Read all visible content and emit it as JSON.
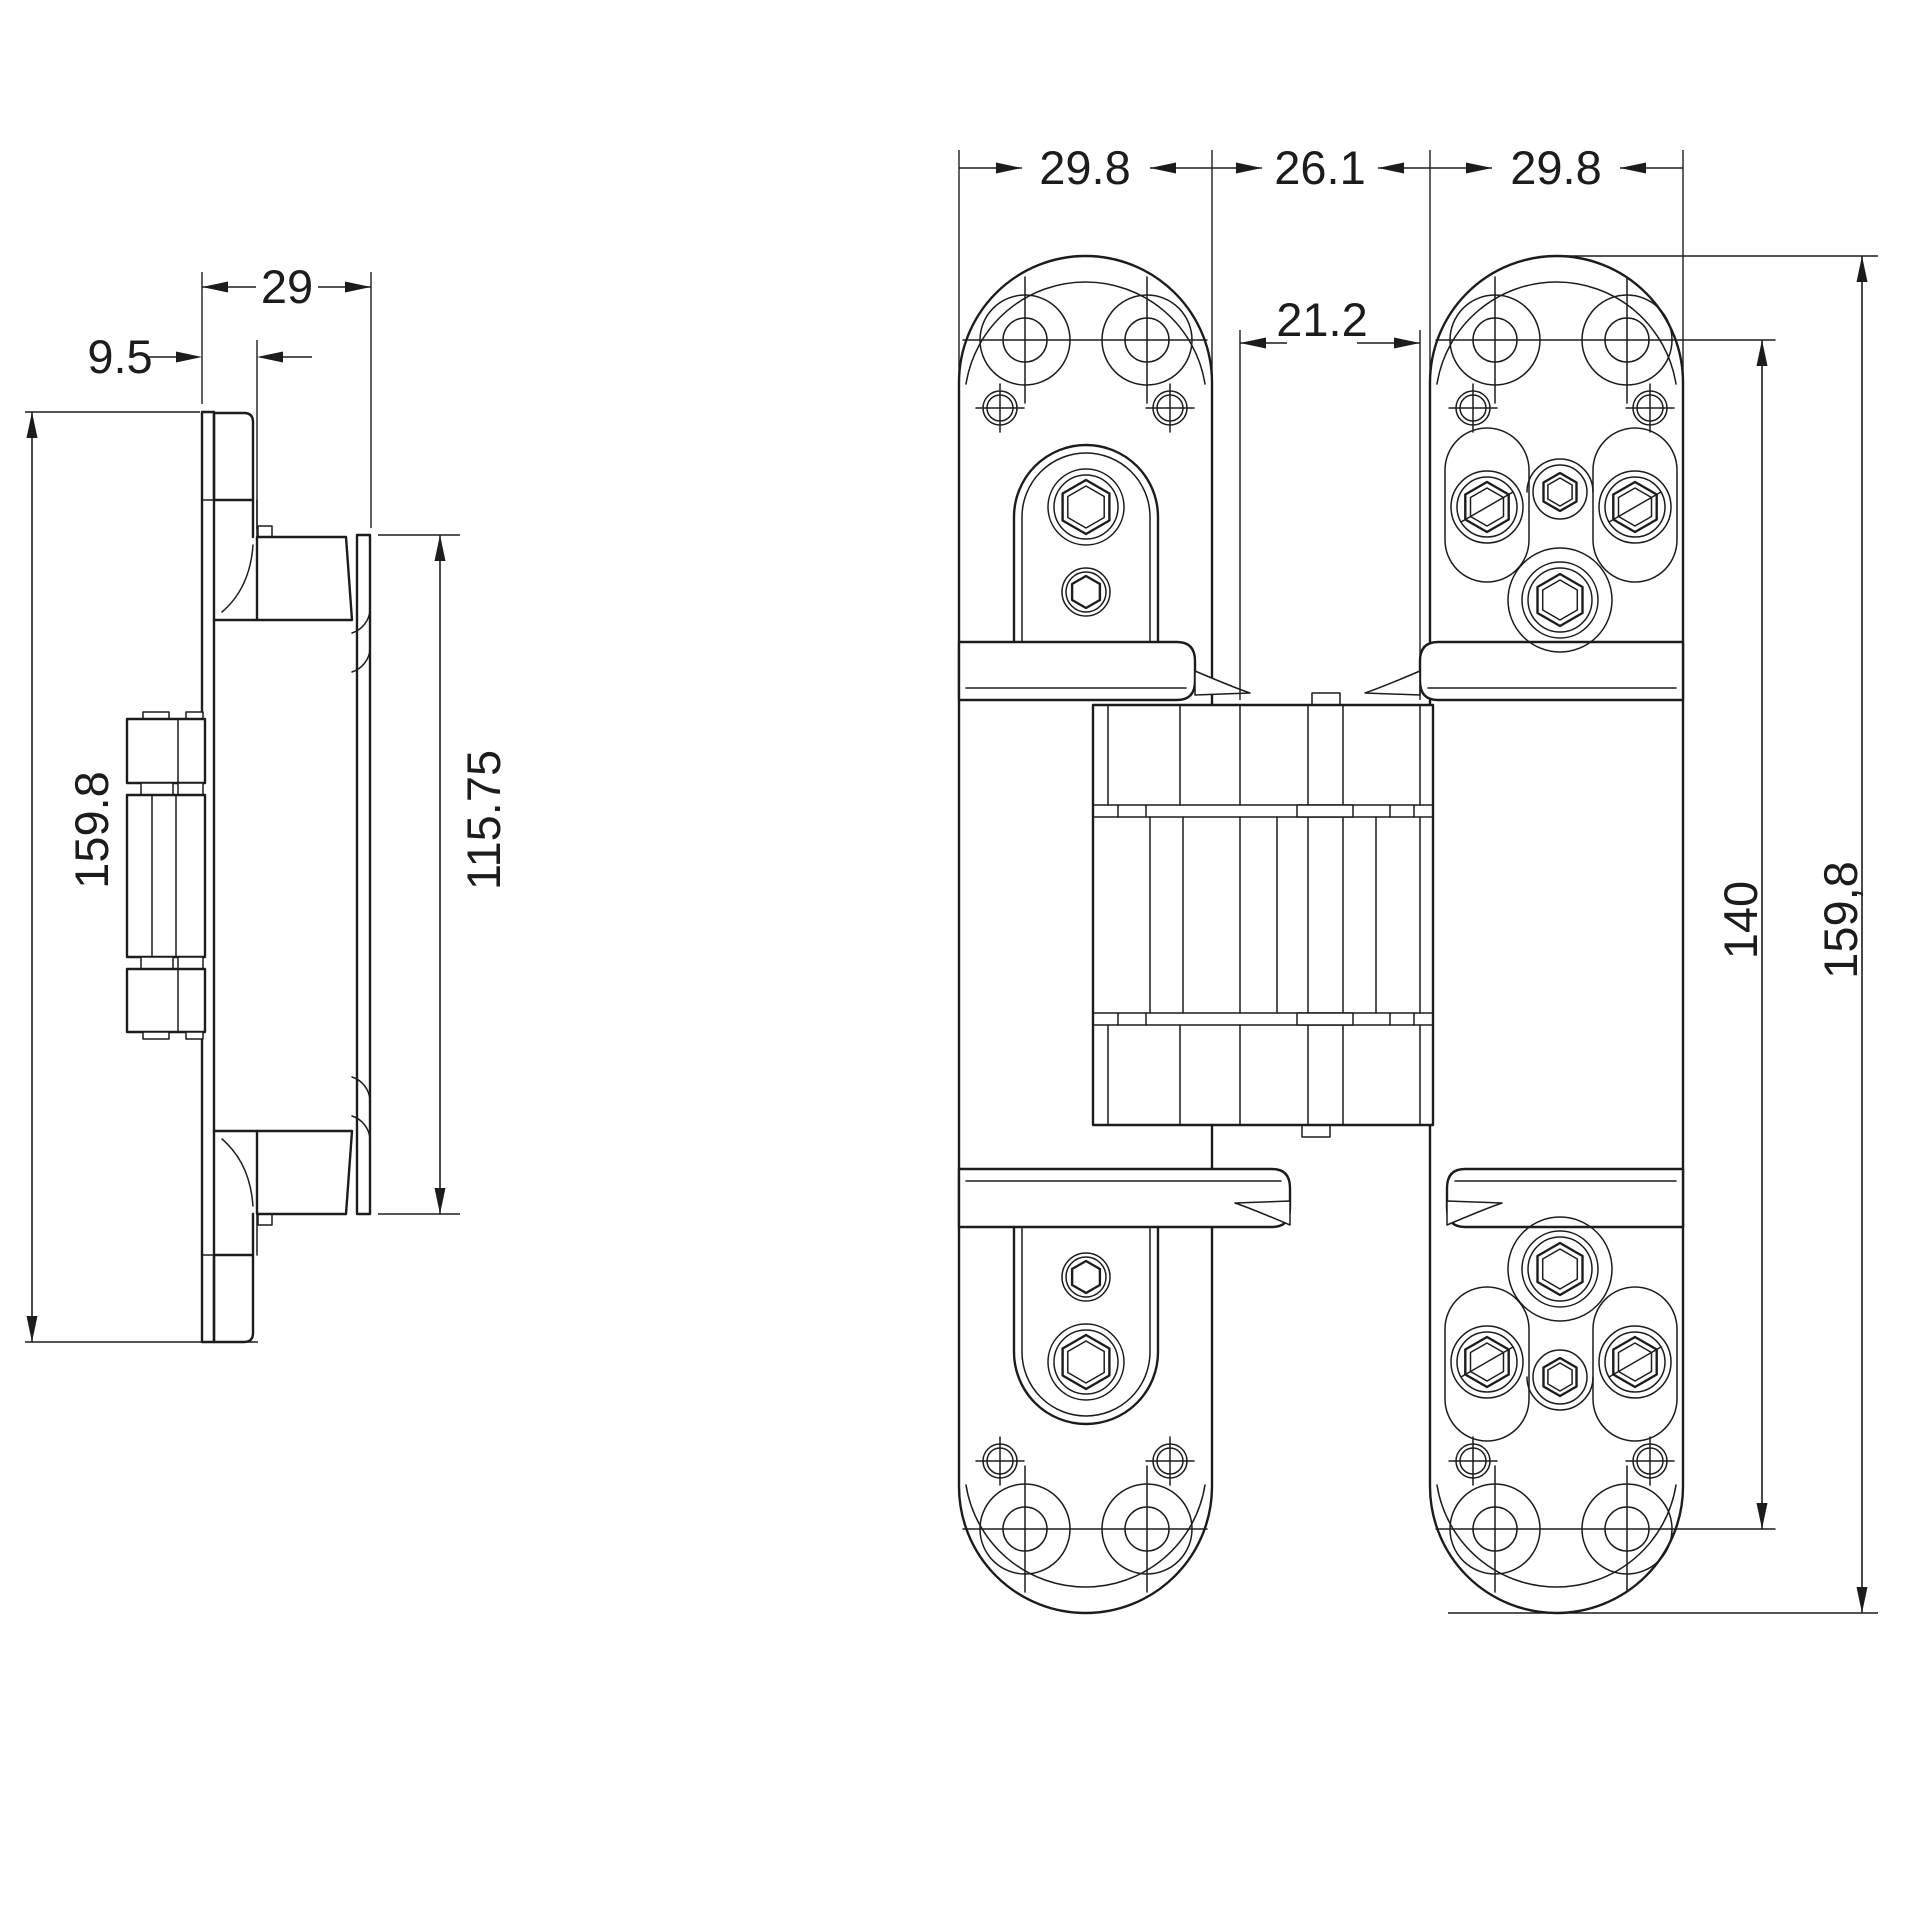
{
  "drawing": {
    "title": "concealed-hinge-dimension-drawing",
    "background_color": "#ffffff",
    "line_color": "#1c1c1c",
    "views": {
      "side_view": {
        "label": "side-profile-view",
        "dimensions": {
          "leaf_thickness": "9.5",
          "total_depth": "29",
          "overall_height": "159.8",
          "fitting_height": "115.75"
        }
      },
      "front_view": {
        "label": "front-view",
        "dimensions": {
          "left_leaf_width": "29.8",
          "center_gap": "26.1",
          "right_leaf_width": "29.8",
          "body_width": "21.2",
          "screw_span": "140",
          "overall_height": "159,8"
        }
      }
    }
  }
}
